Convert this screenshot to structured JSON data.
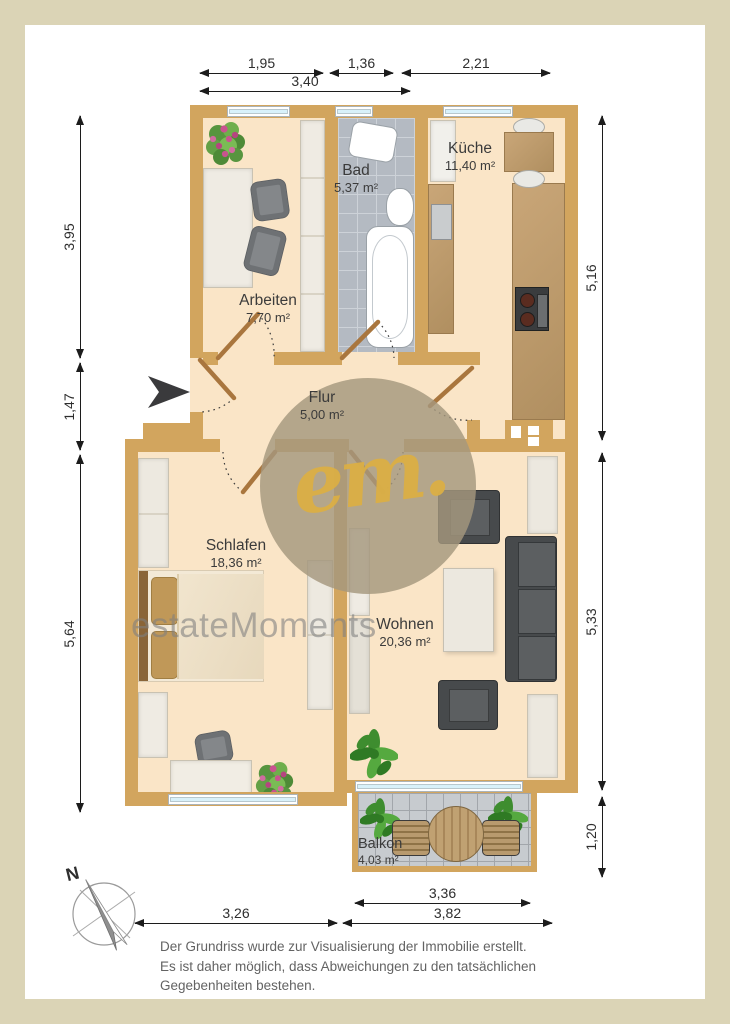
{
  "floorplan": {
    "rooms": [
      {
        "name": "Arbeiten",
        "area": "7,70 m²"
      },
      {
        "name": "Bad",
        "area": "5,37 m²"
      },
      {
        "name": "Küche",
        "area": "11,40 m²"
      },
      {
        "name": "Flur",
        "area": "5,00 m²"
      },
      {
        "name": "Schlafen",
        "area": "18,36 m²"
      },
      {
        "name": "Wohnen",
        "area": "20,36 m²"
      },
      {
        "name": "Balkon",
        "area": "4,03 m²"
      }
    ],
    "dimensions_top": [
      {
        "value": "1,95"
      },
      {
        "value": "1,36"
      },
      {
        "value": "2,21"
      },
      {
        "value": "3,40"
      }
    ],
    "dimensions_left": [
      {
        "value": "3,95"
      },
      {
        "value": "1,47"
      },
      {
        "value": "5,64"
      }
    ],
    "dimensions_right": [
      {
        "value": "5,16"
      },
      {
        "value": "5,33"
      },
      {
        "value": "1,20"
      }
    ],
    "dimensions_bottom": [
      {
        "value": "3,26"
      },
      {
        "value": "3,36"
      },
      {
        "value": "3,82"
      }
    ],
    "compass": {
      "north_label": "N"
    },
    "watermark": {
      "logo_text": "em.",
      "brand_text": "estateMoments"
    },
    "disclaimer": {
      "line1": "Der Grundriss wurde zur Visualisierung der Immobilie erstellt.",
      "line2": "Es ist daher möglich, dass Abweichungen zu den tatsächlichen",
      "line3": "Gegebenheiten bestehen."
    },
    "colors": {
      "wall": "#D2A55E",
      "floor": "#FAE5C7",
      "bath_tiles": "#B4BAC2",
      "balcony_tiles": "#C7CBCF",
      "window_glass": "#D8F1FA",
      "page_frame": "#DBD4B6",
      "watermark_gold": "#DBAF45"
    }
  }
}
